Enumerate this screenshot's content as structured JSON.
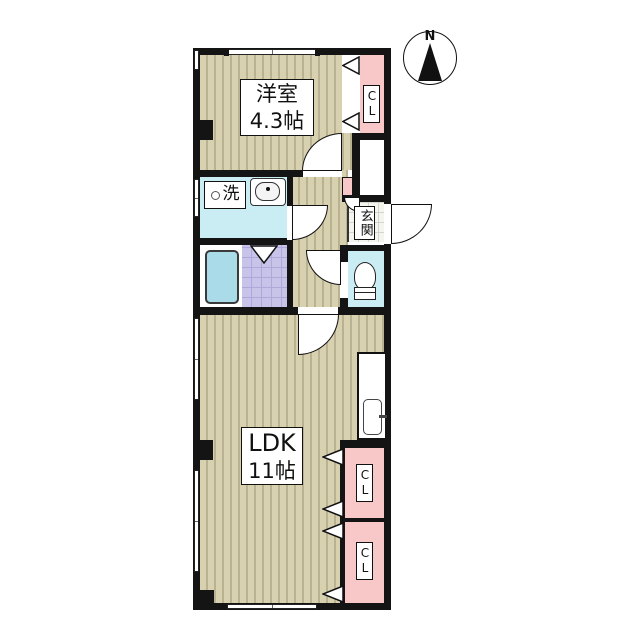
{
  "compass": {
    "label": "N"
  },
  "rooms": {
    "western_room": {
      "name": "洋室",
      "size": "4.3帖"
    },
    "ldk": {
      "name": "LDK",
      "size": "11帖"
    },
    "washroom": {
      "label": "洗"
    },
    "entrance": {
      "label": "玄関"
    },
    "closet_top": {
      "label": "CL"
    },
    "closet_lower_1": {
      "label": "CL"
    },
    "closet_lower_2": {
      "label": "CL"
    }
  },
  "colors": {
    "wall": "#141414",
    "wood_floor_base": "#d7d1b0",
    "wood_floor_stripe": "#b9b292",
    "closet_pink": "#f8c7c7",
    "water_area_cyan": "#c9edf3",
    "bathtub_fill": "#a9dbe9",
    "bath_tile_purple": "#c8c4e9",
    "entrance_tile": "#f5f5f0"
  }
}
